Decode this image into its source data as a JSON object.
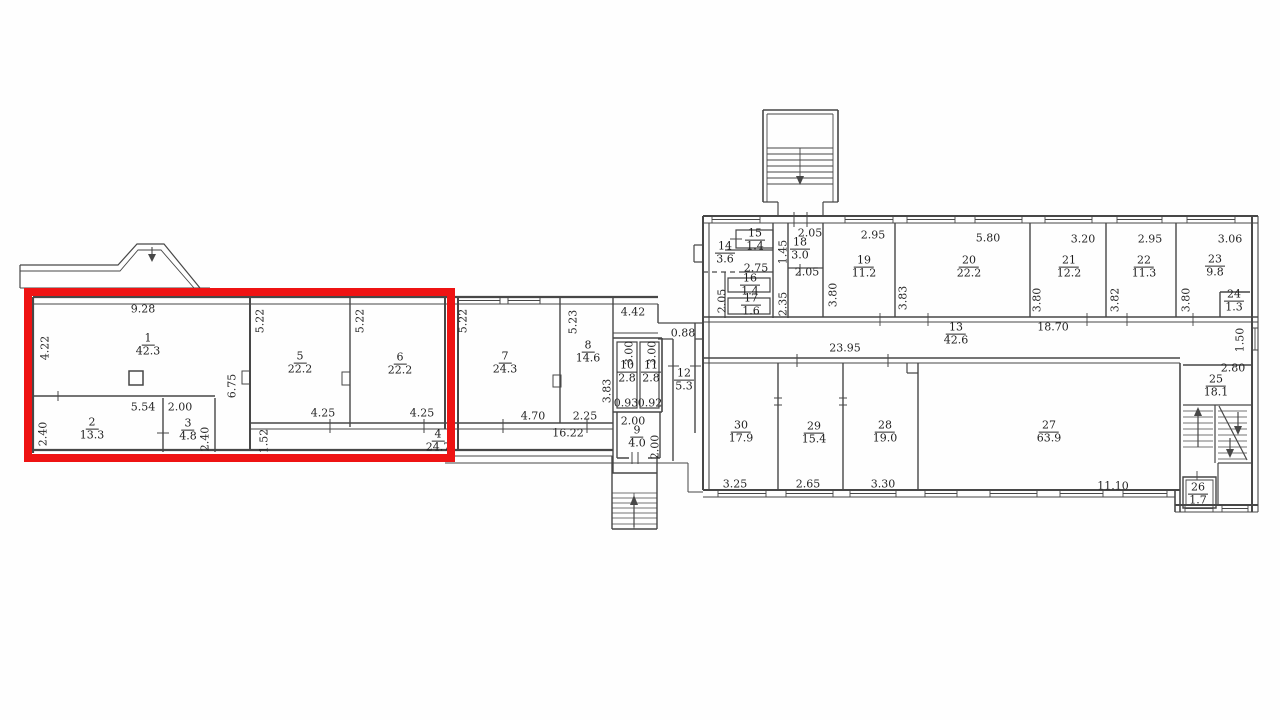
{
  "plan": {
    "highlight_color": "#ee1313",
    "rooms": [
      {
        "number": "1",
        "area": "42.3"
      },
      {
        "number": "2",
        "area": "13.3"
      },
      {
        "number": "3",
        "area": "4.8"
      },
      {
        "number": "4",
        "area": "24.7"
      },
      {
        "number": "5",
        "area": "22.2"
      },
      {
        "number": "6",
        "area": "22.2"
      },
      {
        "number": "7",
        "area": "24.3"
      },
      {
        "number": "8",
        "area": "14.6"
      },
      {
        "number": "9",
        "area": "4.0"
      },
      {
        "number": "10",
        "area": "2.8"
      },
      {
        "number": "11",
        "area": "2.8"
      },
      {
        "number": "12",
        "area": "5.3"
      },
      {
        "number": "13",
        "area": "42.6"
      },
      {
        "number": "14",
        "area": "3.6"
      },
      {
        "number": "15",
        "area": "1.4"
      },
      {
        "number": "16",
        "area": "1.4"
      },
      {
        "number": "17",
        "area": "1.6"
      },
      {
        "number": "18",
        "area": "3.0"
      },
      {
        "number": "19",
        "area": "11.2"
      },
      {
        "number": "20",
        "area": "22.2"
      },
      {
        "number": "21",
        "area": "12.2"
      },
      {
        "number": "22",
        "area": "11.3"
      },
      {
        "number": "23",
        "area": "9.8"
      },
      {
        "number": "24",
        "area": "1.3"
      },
      {
        "number": "25",
        "area": "18.1"
      },
      {
        "number": "26",
        "area": "1.7"
      },
      {
        "number": "27",
        "area": "63.9"
      },
      {
        "number": "28",
        "area": "19.0"
      },
      {
        "number": "29",
        "area": "15.4"
      },
      {
        "number": "30",
        "area": "17.9"
      }
    ],
    "dims": [
      "9.28",
      "4.22",
      "5.54",
      "2.00",
      "2.40",
      "2.40",
      "6.75",
      "5.22",
      "5.22",
      "4.25",
      "4.25",
      "1.52",
      "5.22",
      "5.23",
      "4.42",
      "0.88",
      "3.00",
      "3.00",
      "3.83",
      "0.93",
      "0.92",
      "4.70",
      "2.25",
      "16.22",
      "2.00",
      "2.00",
      "2.05",
      "2.95",
      "5.80",
      "3.20",
      "2.95",
      "3.06",
      "1.45",
      "2.75",
      "2.05",
      "2.05",
      "2.35",
      "3.80",
      "3.83",
      "3.80",
      "3.82",
      "3.80",
      "18.70",
      "1.50",
      "23.95",
      "2.80",
      "3.25",
      "2.65",
      "3.30",
      "11.10"
    ]
  }
}
